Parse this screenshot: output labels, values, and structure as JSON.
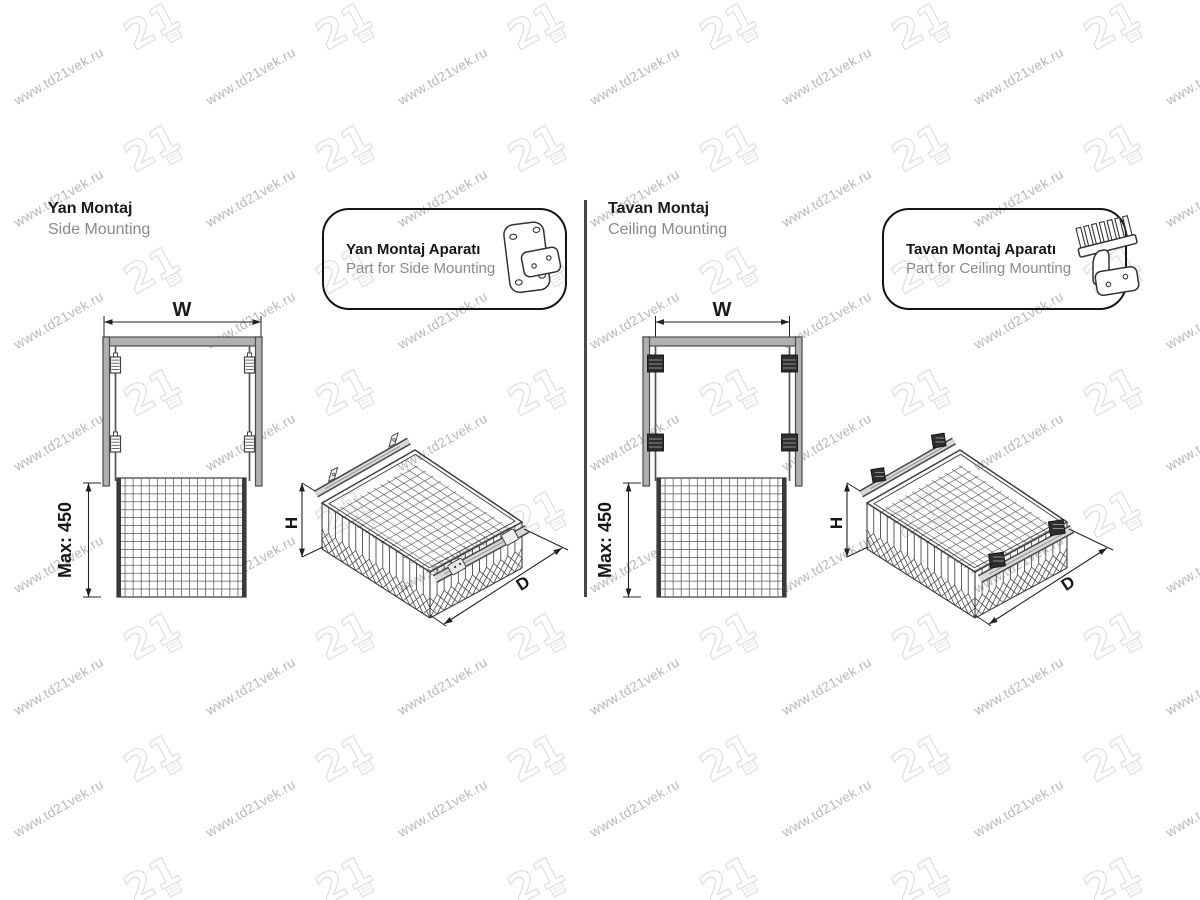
{
  "watermark": {
    "url": "www.td21vek.ru",
    "logo": "21"
  },
  "panels": [
    {
      "title": "Yan Montaj",
      "subtitle": "Side Mounting",
      "callout": {
        "title": "Yan Montaj Aparatı",
        "subtitle": "Part for Side Mounting"
      },
      "dims": {
        "width": "W",
        "height": "H",
        "depth": "D",
        "max_height": "Max: 450"
      }
    },
    {
      "title": "Tavan Montaj",
      "subtitle": "Ceiling Mounting",
      "callout": {
        "title": "Tavan Montaj Aparatı",
        "subtitle": "Part for Ceiling Mounting"
      },
      "dims": {
        "width": "W",
        "height": "H",
        "depth": "D",
        "max_height": "Max: 450"
      }
    }
  ],
  "colors": {
    "line": "#3f3f3f",
    "frame_fill": "#b0b0b0",
    "text_dark": "#1b1b1b",
    "text_gray": "#8a8a8a",
    "watermark_text": "#b8b8b8",
    "watermark_logo": "#dcdcdc"
  }
}
